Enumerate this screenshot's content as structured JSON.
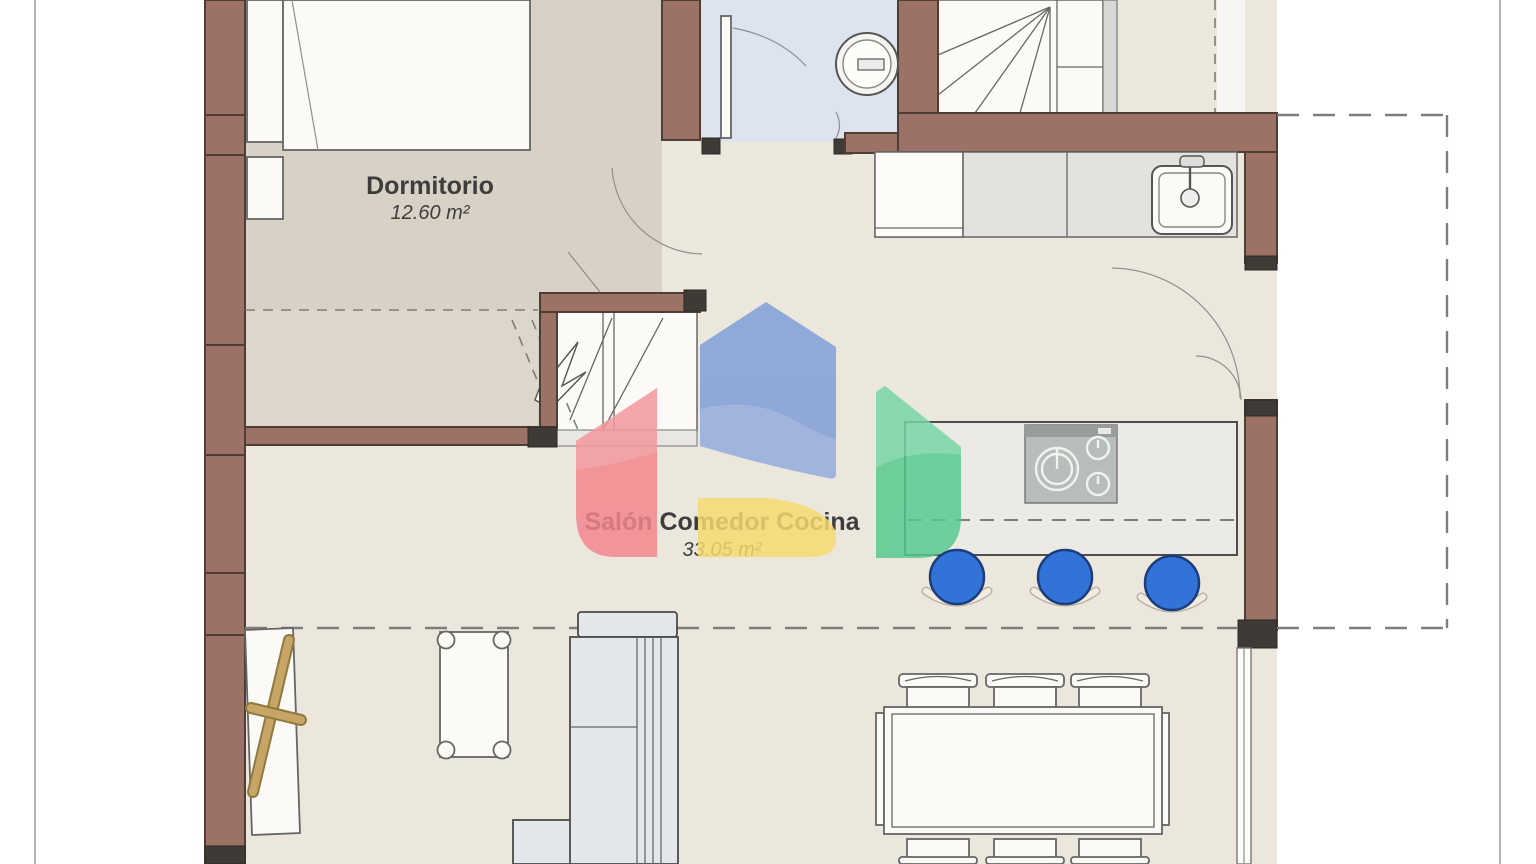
{
  "page": {
    "background": "#ffffff",
    "border_color": "#a0a0a0"
  },
  "rooms": [
    {
      "name": "Dormitorio",
      "area": "12.60 m²"
    },
    {
      "name": "Salón Comedor Cocina",
      "area": "33.05 m²"
    }
  ],
  "colors": {
    "wall": "#9d7266",
    "wall_outline": "#4f3e35",
    "wall_dark": "#3e3a36",
    "floor_living": "#ece7dd",
    "floor_bedroom": "#d8d1c6",
    "floor_bedroom_light": "#ddd6ca",
    "floor_bath": "#dde4ef",
    "stairs_white": "#fbfaf7",
    "counter": "#e3e2df",
    "cabinet_white": "#fcfbf8",
    "island": "#ebeae5",
    "stove": "#b8bcbb",
    "stove_strip": "#979d9d",
    "stool": "#3273d8",
    "stool_outline": "#1d3c7c",
    "wood": "#c7a566",
    "wood_dark": "#8f7a3e",
    "sofa": "#e4e7ea",
    "furniture_white": "#fbfaf6",
    "line": "#666666",
    "dash": "#7d7d7d",
    "text": "#3d3d3d"
  },
  "watermark": {
    "blue": "#7d9dd6",
    "blue_light": "#92abdd",
    "red": "#f2868d",
    "red_light": "#f5a3a8",
    "yellow": "#f6dc70",
    "green": "#55ca8e",
    "green_light": "#80d7ab",
    "opacity": "0.84"
  }
}
